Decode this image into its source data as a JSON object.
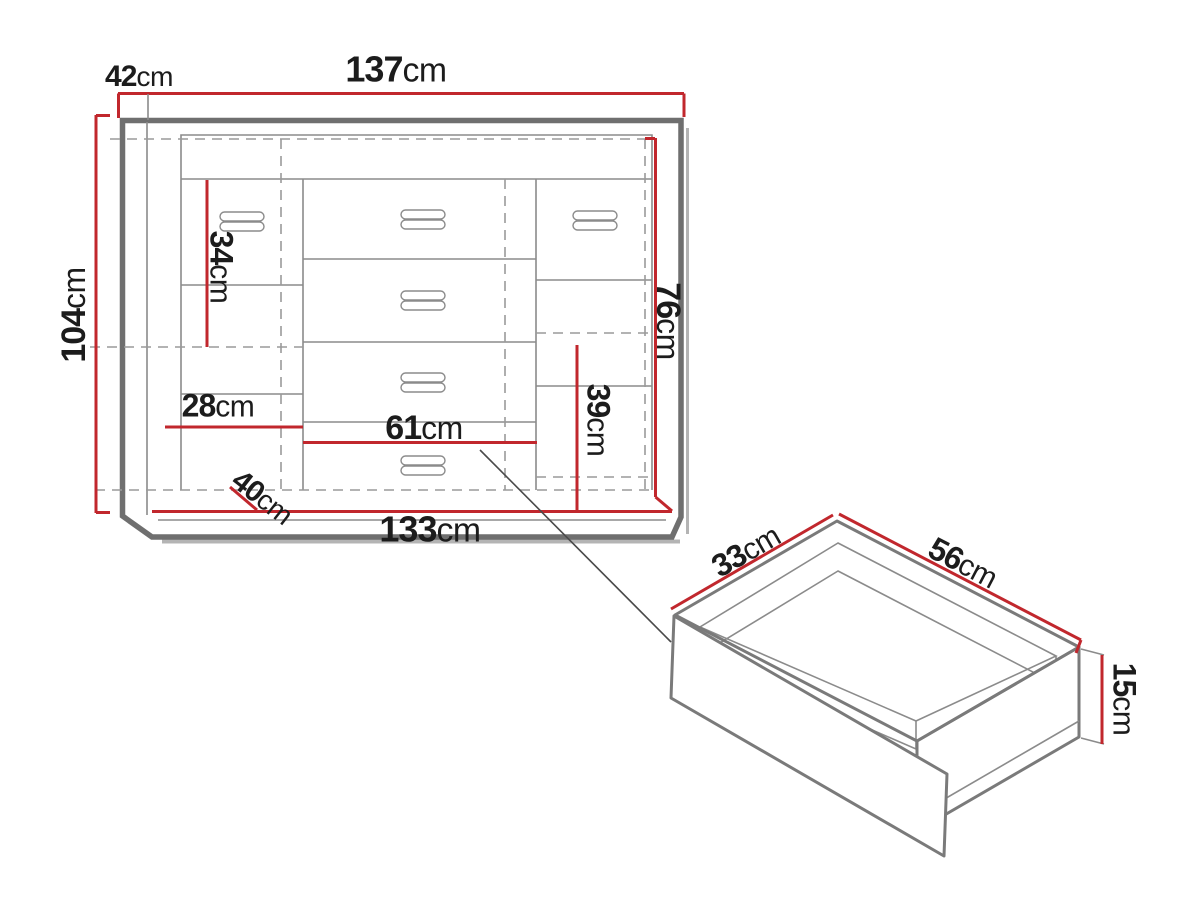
{
  "page": {
    "background": "#ffffff"
  },
  "colors": {
    "dimension_red": "#c1272d",
    "frame_gray": "#6f6f6f",
    "line_gray": "#8b8b8b",
    "dashed_gray": "#9a9a9a",
    "shadow_gray": "#b4b4b4",
    "text": "#1c1c1c",
    "pointer": "#4a4a4a"
  },
  "dims": {
    "depth": {
      "num": "42",
      "unit": "cm",
      "value_cm": 42
    },
    "width_top": {
      "num": "137",
      "unit": "cm",
      "value_cm": 137
    },
    "height": {
      "num": "104",
      "unit": "cm",
      "value_cm": 104
    },
    "left_inner_height": {
      "num": "34",
      "unit": "cm",
      "value_cm": 34
    },
    "right_door_height": {
      "num": "76",
      "unit": "cm",
      "value_cm": 76
    },
    "left_shelf_width": {
      "num": "28",
      "unit": "cm",
      "value_cm": 28
    },
    "drawer_section_width": {
      "num": "61",
      "unit": "cm",
      "value_cm": 61
    },
    "right_inner_height": {
      "num": "39",
      "unit": "cm",
      "value_cm": 39
    },
    "base_depth": {
      "num": "40",
      "unit": "cm",
      "value_cm": 40
    },
    "width_bottom": {
      "num": "133",
      "unit": "cm",
      "value_cm": 133
    },
    "drawer_depth": {
      "num": "33",
      "unit": "cm",
      "value_cm": 33
    },
    "drawer_width": {
      "num": "56",
      "unit": "cm",
      "value_cm": 56
    },
    "drawer_height": {
      "num": "15",
      "unit": "cm",
      "value_cm": 15
    }
  }
}
